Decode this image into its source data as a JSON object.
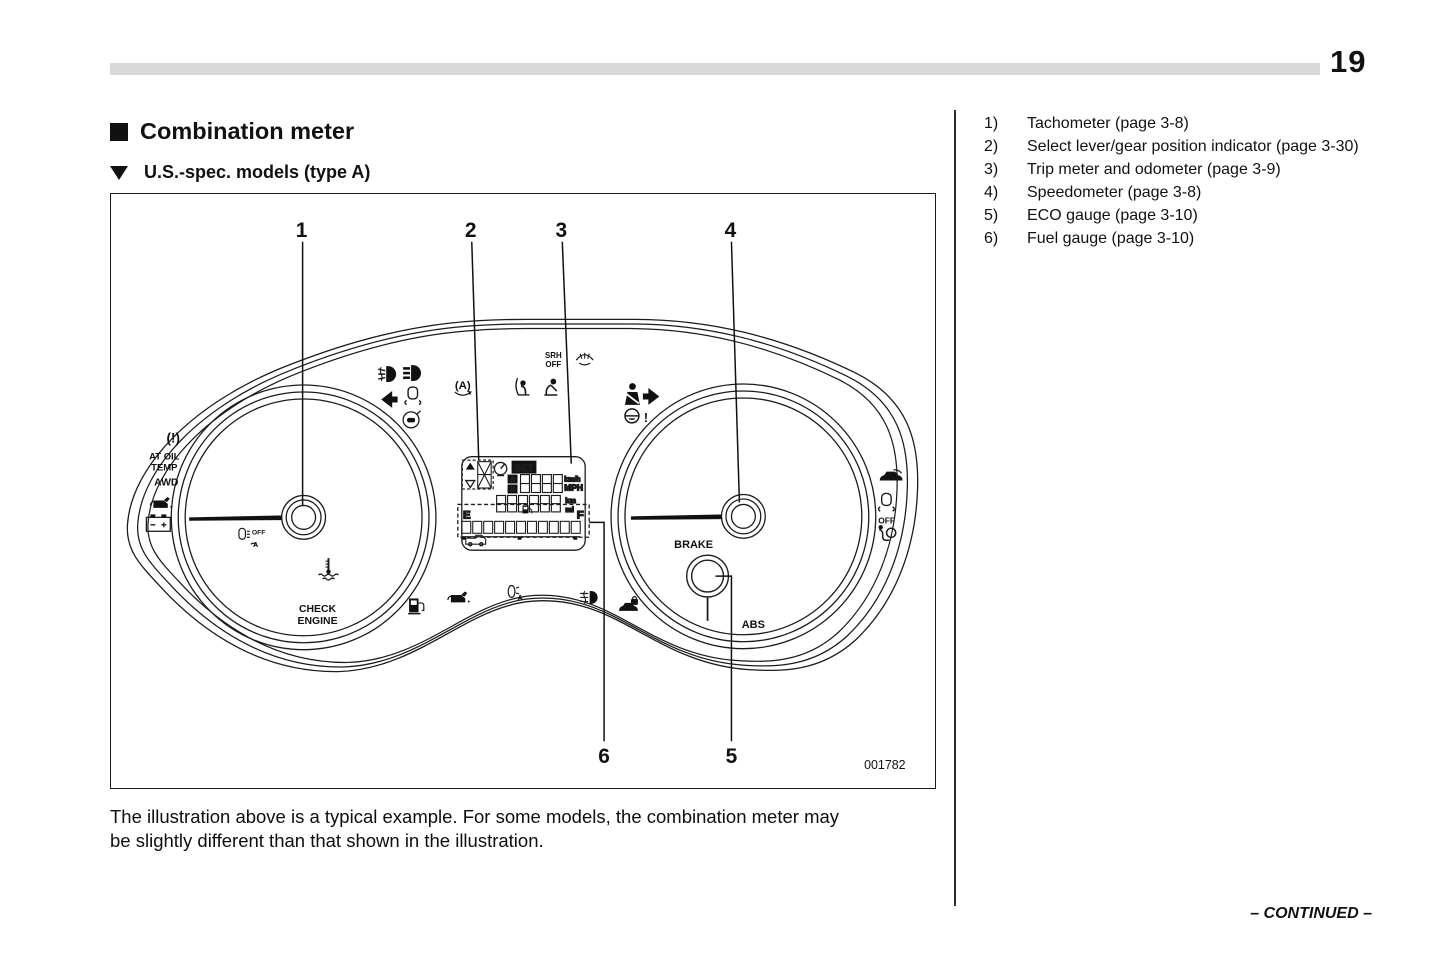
{
  "page": {
    "number": "19",
    "continued": "– CONTINUED –"
  },
  "headings": {
    "section": "Combination meter",
    "subsection": "U.S.-spec. models (type A)"
  },
  "legend": {
    "items": [
      {
        "num": "1)",
        "label": "Tachometer (page 3-8)"
      },
      {
        "num": "2)",
        "label": "Select lever/gear position indicator (page 3-30)"
      },
      {
        "num": "3)",
        "label": "Trip meter and odometer (page 3-9)"
      },
      {
        "num": "4)",
        "label": "Speedometer (page 3-8)"
      },
      {
        "num": "5)",
        "label": "ECO gauge (page 3-10)"
      },
      {
        "num": "6)",
        "label": "Fuel gauge (page 3-10)"
      }
    ]
  },
  "caption": {
    "line1": "The illustration above is a typical example. For some models, the combination meter may",
    "line2": "be slightly different than that shown in the illustration."
  },
  "figure": {
    "figure_number": "001782",
    "callouts": {
      "n1": "1",
      "n2": "2",
      "n3": "3",
      "n4": "4",
      "n5": "5",
      "n6": "6"
    },
    "labels": {
      "tpms": "(!)",
      "at_oil_line1": "AT OIL",
      "at_oil_line2": "TEMP",
      "awd": "AWD",
      "headlight_off": "OFF",
      "headlight_off_a": "A",
      "check_line1": "CHECK",
      "check_line2": "ENGINE",
      "srh_line1": "SRH",
      "srh_line2": "OFF",
      "auto_stop": "(A)",
      "set": "SET",
      "trip_a": "A",
      "trip_b": "B",
      "unit_kmh": "km/h",
      "unit_mph": "MPH",
      "unit_km": "km",
      "unit_mi": "mi",
      "fuel_e": "E",
      "fuel_f": "F",
      "leveling_a": "A",
      "brake": "BRAKE",
      "abs": "ABS",
      "vdc_off": "OFF",
      "steering_excl": "!"
    },
    "icons": [
      "tpms-warning",
      "at-oil-temp",
      "awd",
      "oil-pressure",
      "charge-battery",
      "headlight-auto-off",
      "coolant-temp",
      "check-engine",
      "front-fog",
      "high-beam",
      "turn-left",
      "vdc-warning",
      "hill-start-assist",
      "auto-stop-start",
      "passenger-airbag",
      "srs-warning",
      "srh-off",
      "washer-fluid",
      "seatbelt-warning",
      "turn-right",
      "steering-warning",
      "cruise-set",
      "gear-position",
      "trip-display",
      "fuel-gauge",
      "car-ahead",
      "fuel-low",
      "oil-level",
      "headlight-leveling",
      "rear-fog",
      "security",
      "brake-gauge-hub",
      "abs-warning",
      "eco-gauge",
      "rear-hatch",
      "vdc-off",
      "airbag-warning"
    ]
  }
}
